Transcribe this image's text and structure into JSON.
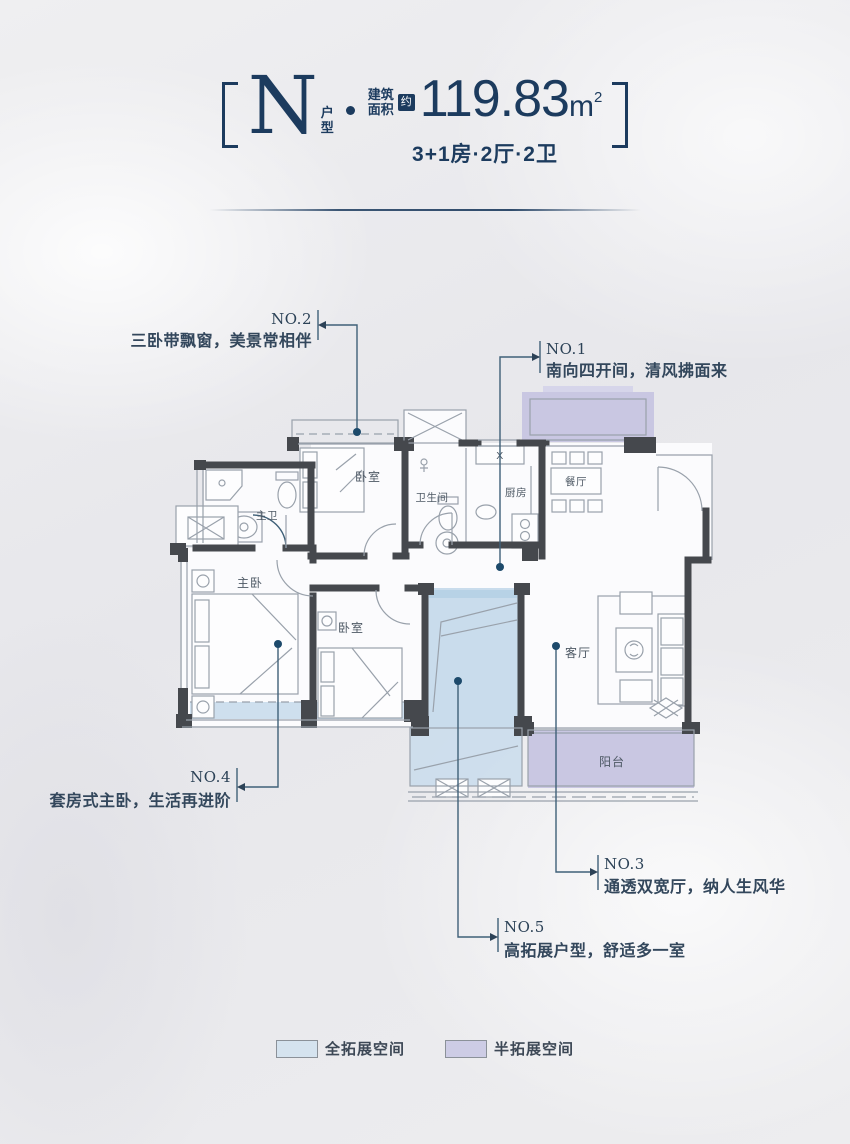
{
  "header": {
    "bracket_left": "[",
    "bracket_right": "]",
    "type_letter": "N",
    "type_suffix_1": "户",
    "type_suffix_2": "型",
    "area_label_line1": "建筑",
    "area_label_line2": "面积",
    "approx_badge": "约",
    "area_value": "119.83",
    "area_unit": "m",
    "area_exponent": "2",
    "layout_spec": "3+1房·2厅·2卫"
  },
  "floorplan": {
    "room_labels": {
      "bedroom_top": "卧室",
      "bathroom": "卫生间",
      "kitchen": "厨房",
      "dining": "餐厅",
      "master_bath": "主卫",
      "master_bedroom": "主卧",
      "bedroom_mid": "卧室",
      "living": "客厅",
      "balcony": "阳台",
      "stove_box": "X"
    },
    "annotations": [
      {
        "tag": "NO.2",
        "text": "三卧带飘窗，美景常相伴"
      },
      {
        "tag": "NO.1",
        "text": "南向四开间，清风拂面来"
      },
      {
        "tag": "NO.3",
        "text": "通透双宽厅，纳人生风华"
      },
      {
        "tag": "NO.4",
        "text": "套房式主卧，生活再进阶"
      },
      {
        "tag": "NO.5",
        "text": "高拓展户型，舒适多一室"
      }
    ]
  },
  "legend": {
    "items": [
      {
        "label": "全拓展空间",
        "color": "#d5e3ef"
      },
      {
        "label": "半拓展空间",
        "color": "#cdcce5"
      }
    ]
  },
  "colors": {
    "accent_navy": "#1c3b5e",
    "full_expand_fill": "#c9dcec",
    "half_expand_fill": "#c9c7e2",
    "wall": "#45484d",
    "annotation_line": "#3f6078"
  }
}
